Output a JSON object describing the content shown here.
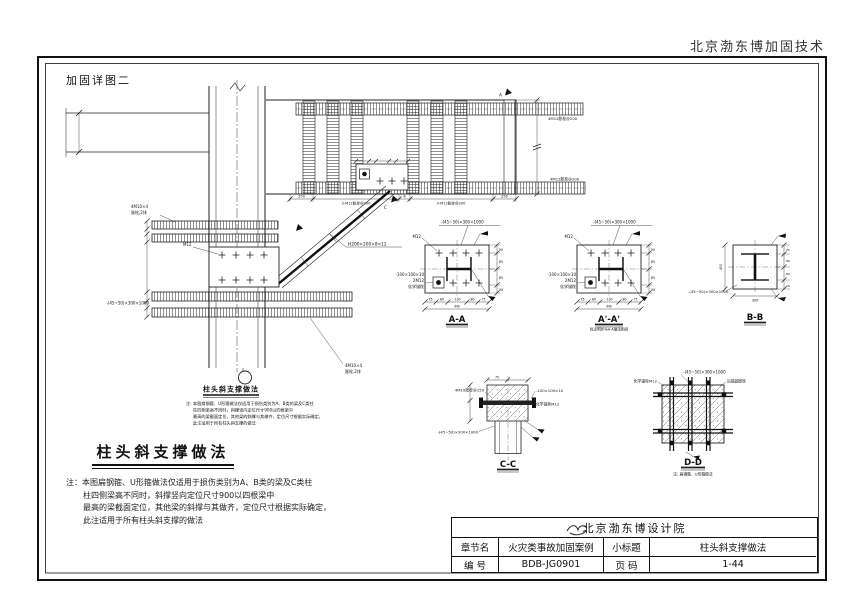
{
  "page": {
    "vendor_header": "北京渤东博加固技术",
    "figure_label": "加固详图二"
  },
  "title_block": {
    "company": "北京渤东博设计院",
    "row1": {
      "label_a": "章节名",
      "value_a": "火灾类事故加固案例",
      "label_b": "小标题",
      "value_b": "柱头斜支撑做法"
    },
    "row2": {
      "label_a": "编  号",
      "value_a": "BDB-JG0901",
      "label_b": "页  码",
      "value_b": "1-44"
    }
  },
  "notes_block": {
    "title": "柱头斜支撑做法",
    "lines": [
      "注：本图扁钢箍、U形箍做法仅适用于损伤类别为A、B类的梁及C类柱",
      "柱四侧梁高不同时，斜撑竖向定位尺寸900以四根梁中",
      "最高的梁截面定位，其他梁的斜撑与其做齐，定位尺寸根据实际确定，",
      "此注适用于所有柱头斜支撑的做法"
    ]
  },
  "detail": {
    "title": "柱头斜支撑做法",
    "note_lines": [
      "注: 本图扁钢箍、U形箍做法仅适用于损伤类别为A、B类的梁及C类柱",
      "柱四侧梁高不同时，斜撑竖向定位尺寸900以四根梁中",
      "最高的梁截面定位，其他梁的斜撑与其做齐，定位尺寸根据实际确定，",
      "此注适用于所有柱头斜支撑的做法"
    ]
  },
  "sections": {
    "aa": "A-A",
    "aa2": "A'-A'",
    "aa2_note": "除注明外与A-A做法相同",
    "bb": "B-B",
    "cc": "C-C",
    "dd": "D-D",
    "dd_note": "注: 扁钢箍、U形箍做法"
  },
  "labels": {
    "brace_spec": "H200×200×8×12",
    "flat_steel": "-(45~50)×300×1000",
    "anchor_row1": "4M10×4",
    "anchor_row2": "胀栓,2排",
    "m12": "M12",
    "plate": "-100×100×10",
    "bolts2": "2M12",
    "chem_anchor": "化学锚栓",
    "chem_anchor_m12": "化学锚栓M12",
    "rear_anchor": "后锚固胀栓",
    "anchor_150": "4M10胀栓@150",
    "anchor_200": "3-M12胀栓@200",
    "anchor_200b": "4M12胀栓@200",
    "letter_a": "A",
    "letter_c": "C"
  },
  "dims": {
    "d250": "250",
    "d8": "8",
    "d75": "75",
    "d80": "80",
    "d130": "130",
    "d440": "440",
    "d50": "50",
    "d65": "65",
    "d25": "25",
    "d300": "300",
    "d400": "400"
  }
}
